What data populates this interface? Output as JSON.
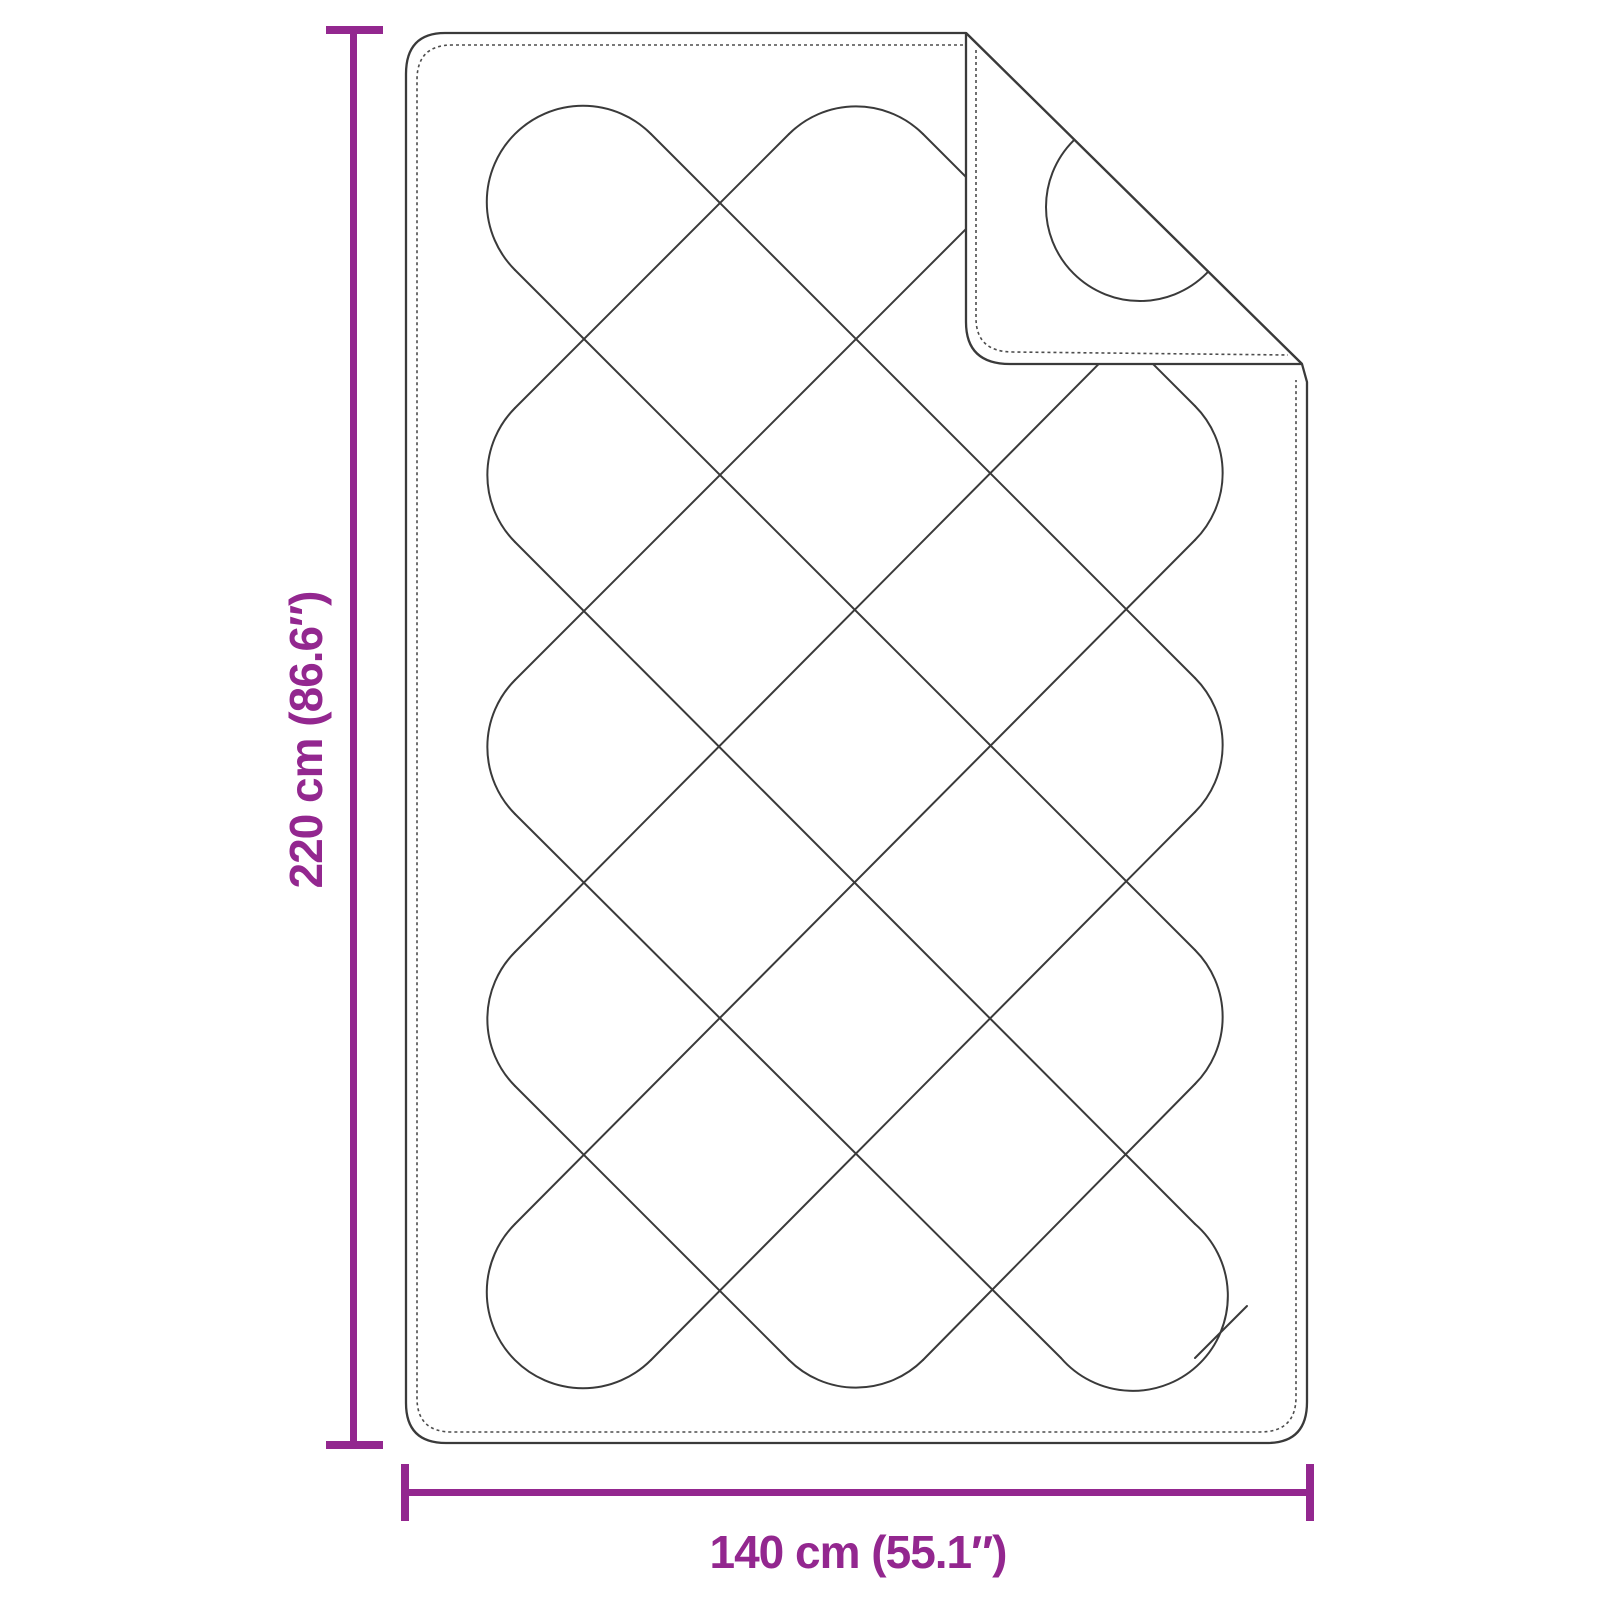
{
  "labels": {
    "height": "220 cm (86.6″)",
    "width": "140 cm (55.1″)"
  },
  "colors": {
    "background": "#ffffff",
    "outline": "#3a3a3a",
    "stitch": "#4d4d4d",
    "accent": "#93278F"
  },
  "blanket": {
    "outer_path": "M 445 33 L 966 33 L 1302 364 L 1307 382 L 1307 1402 Q 1307 1443 1267 1443 L 446 1443 Q 406 1443 406 1403 L 406 74 Q 406 33 445 33 Z",
    "stitch_path": "M 963 45 L 452 45 Q 417 45 417 80 L 417 1398 Q 417 1432 452 1432 L 1260 1432 Q 1296 1432 1296 1397 L 1296 380"
  },
  "flap": {
    "fill_path": "M 966 33 L 1302 364 L 1010 364 Q 966 364 966 322 Z",
    "crease": [
      966,
      33,
      1302,
      364
    ],
    "edge_path": "M 966 33 L 966 322 Q 966 364 1010 364 L 1302 364",
    "stitch_path": "M 976 50 L 976 318 Q 976 352 1013 352 L 1288 355",
    "circle": {
      "cx": 1140,
      "cy": 207,
      "r": 94
    }
  },
  "pattern": {
    "stroke_width": 2,
    "arcs": [
      "M 651 134 A 95 95 0 1 0 515 270",
      "M 789 134 A 95 95 0 0 1 923 134",
      "M 515 408 A 95 95 0 0 0 515 542",
      "M 515 680 A 95 95 0 0 0 515 814",
      "M 515 952 A 95 95 0 0 0 515 1086",
      "M 515 1224 A 95 95 0 1 0 651 1360",
      "M 789 1360 A 95 95 0 0 0 923 1360",
      "M 1195 406 A 95 95 0 0 1 1195 540",
      "M 1195 678 A 95 95 0 0 1 1195 812",
      "M 1195 950 A 95 95 0 0 1 1195 1084",
      "M 1195 1224 A 95 95 0 1 1 1061 1358"
    ],
    "segments": [
      [
        515,
        270,
        1195,
        950
      ],
      [
        651,
        134,
        1195,
        678
      ],
      [
        923,
        134,
        1195,
        406
      ],
      [
        515,
        542,
        1195,
        1224
      ],
      [
        515,
        814,
        1061,
        1358
      ],
      [
        515,
        1086,
        789,
        1360
      ],
      [
        789,
        134,
        515,
        408
      ],
      [
        1061,
        134,
        515,
        680
      ],
      [
        1195,
        267,
        515,
        952
      ],
      [
        1195,
        540,
        515,
        1224
      ],
      [
        1195,
        812,
        651,
        1360
      ],
      [
        1195,
        1084,
        923,
        1360
      ],
      [
        1195,
        1358,
        1247,
        1306
      ]
    ]
  },
  "dims": {
    "color": "#93278F",
    "height": {
      "line": [
        350,
        30,
        7,
        1415
      ],
      "cap_top": [
        326,
        26,
        57,
        8
      ],
      "cap_bottom": [
        326,
        1441,
        57,
        8
      ]
    },
    "width": {
      "line": [
        403,
        1489,
        908,
        7
      ],
      "cap_left": [
        401,
        1464,
        8,
        57
      ],
      "cap_right": [
        1306,
        1464,
        8,
        57
      ]
    }
  }
}
